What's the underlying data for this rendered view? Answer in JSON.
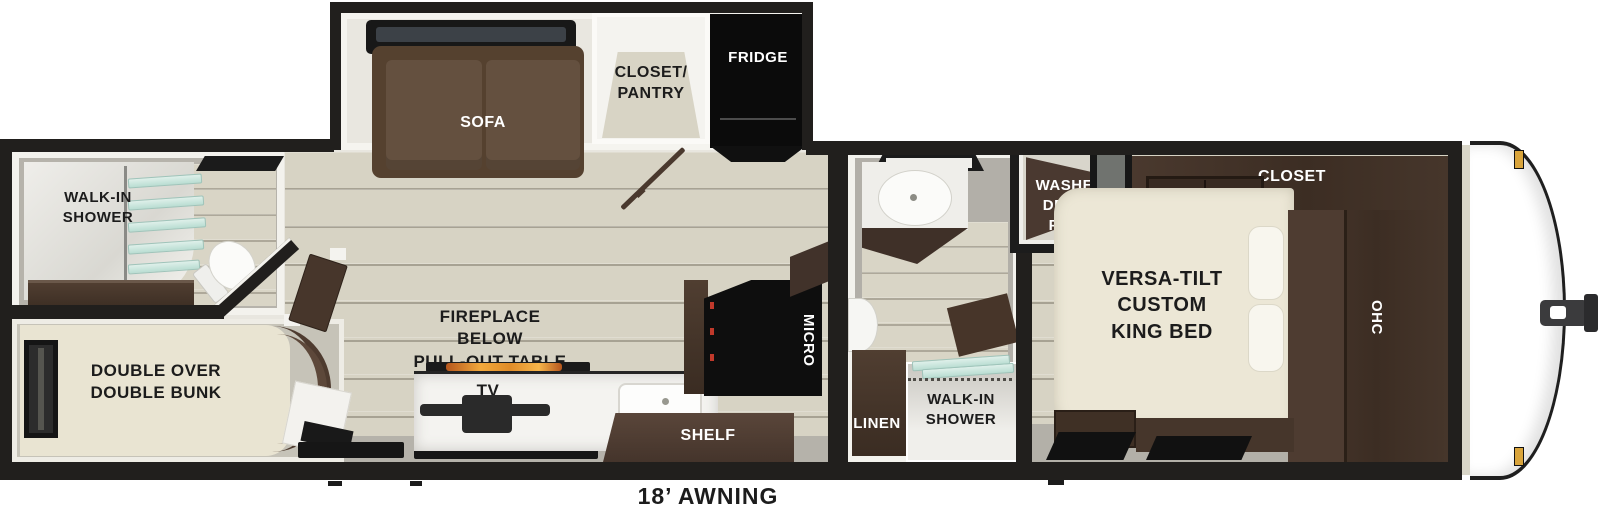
{
  "plan_title": "travel-trailer-floorplan",
  "awning_label": "18’ AWNING",
  "rooms": {
    "rear_bath": {
      "shower_label": "WALK-IN\nSHOWER"
    },
    "bunk_room": {
      "bunk_label": "DOUBLE OVER\nDOUBLE BUNK"
    },
    "slideout": {
      "sofa_label": "SOFA",
      "closet_pantry_label": "CLOSET/\nPANTRY",
      "fridge_label": "FRIDGE"
    },
    "living_kitchen": {
      "fireplace_label": "FIREPLACE\nBELOW\nPULL-OUT TABLE",
      "tv_label": "TV",
      "shelf_label": "SHELF",
      "micro_label": "MICRO"
    },
    "mid_bath": {
      "linen_label": "LINEN",
      "shower_label": "WALK-IN\nSHOWER"
    },
    "utility_closet": {
      "washer_label": "WASHER\nDRYER\nPREP"
    },
    "bedroom": {
      "closet_label": "CLOSET",
      "bed_label": "VERSA-TILT\nCUSTOM\nKING BED",
      "ohc_label": "OHC"
    }
  },
  "colors": {
    "wall": "#211f1d",
    "floor": "#d7d3c4",
    "dark_wood": "#43332a",
    "sofa_brown": "#5f4b3b",
    "mattress_cream": "#eae5d3",
    "appliance_black": "#0c0c0c",
    "shower_glass": "#c7e4dc",
    "marker_gold": "#d9a43b",
    "flame_orange": "#e08c28"
  }
}
